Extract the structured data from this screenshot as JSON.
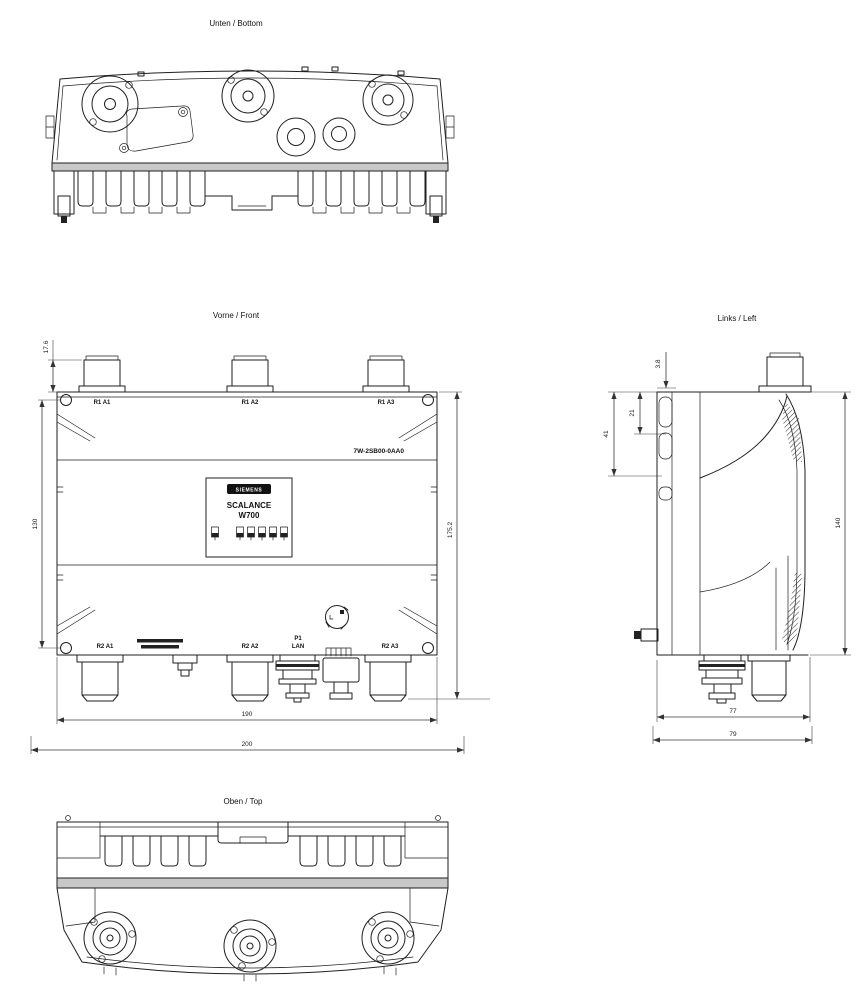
{
  "drawing": {
    "titles": {
      "bottom": "Unten / Bottom",
      "front": "Vorne / Front",
      "left": "Links / Left",
      "top": "Oben / Top"
    },
    "front": {
      "part_number": "7W-2SB00-0AA0",
      "top_ports": [
        "R1 A1",
        "R1 A2",
        "R1 A3"
      ],
      "bottom_ports": [
        "R2 A1",
        "R2 A2",
        "R2 A3"
      ],
      "lan_port": {
        "line1": "P1",
        "line2": "LAN"
      },
      "nameplate": {
        "brand": "SIEMENS",
        "family": "SCALANCE",
        "model": "W700"
      },
      "dims": {
        "antenna_protrusion": "17.6",
        "mount_hole_pitch": "130",
        "overall_height": "175.2",
        "body_width": "190",
        "overall_width": "200"
      }
    },
    "left": {
      "dims": {
        "rail_lip": "3.8",
        "hook_depth": "21",
        "bracket_depth": "41",
        "body_height": "140",
        "body_depth": "77",
        "overall_depth": "79"
      }
    }
  }
}
